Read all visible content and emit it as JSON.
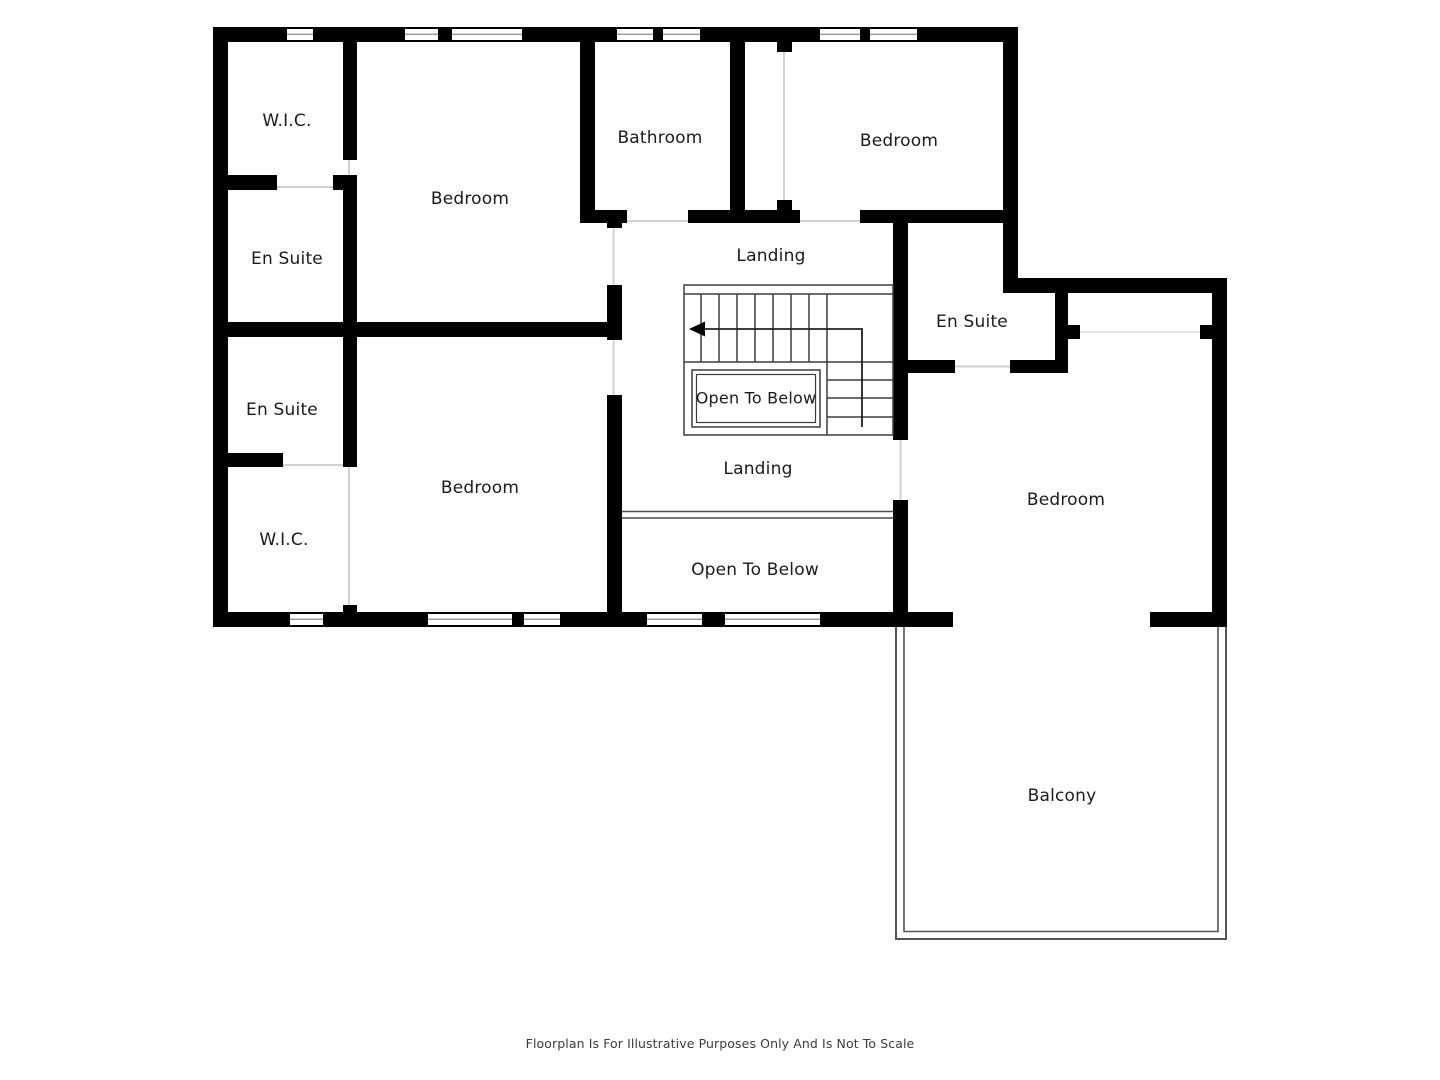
{
  "rooms": {
    "wic_top": "W.I.C.",
    "bedroom_top_left": "Bedroom",
    "bathroom": "Bathroom",
    "bedroom_top_right": "Bedroom",
    "ensuite_top_left": "En Suite",
    "landing_top": "Landing",
    "ensuite_right": "En Suite",
    "open_to_below_stairs": "Open To Below",
    "ensuite_mid_left": "En Suite",
    "wic_bottom": "W.I.C.",
    "bedroom_bottom_left": "Bedroom",
    "landing_bottom": "Landing",
    "bedroom_right": "Bedroom",
    "open_to_below_bottom": "Open To Below",
    "balcony": "Balcony"
  },
  "footer": {
    "disclaimer": "Floorplan Is For Illustrative Purposes Only And Is Not To Scale"
  },
  "colors": {
    "wall": "#000000",
    "background": "#ffffff",
    "door_opening_line": "#d0d0d0",
    "stair_line": "#3d3d3d",
    "balcony_line": "#555555",
    "window_mid_line": "#8f8f8f",
    "label_text": "#1b1b1b",
    "disclaimer_text": "#3c3c3c"
  },
  "icons": {
    "stair_direction_arrow": "left-arrow"
  }
}
